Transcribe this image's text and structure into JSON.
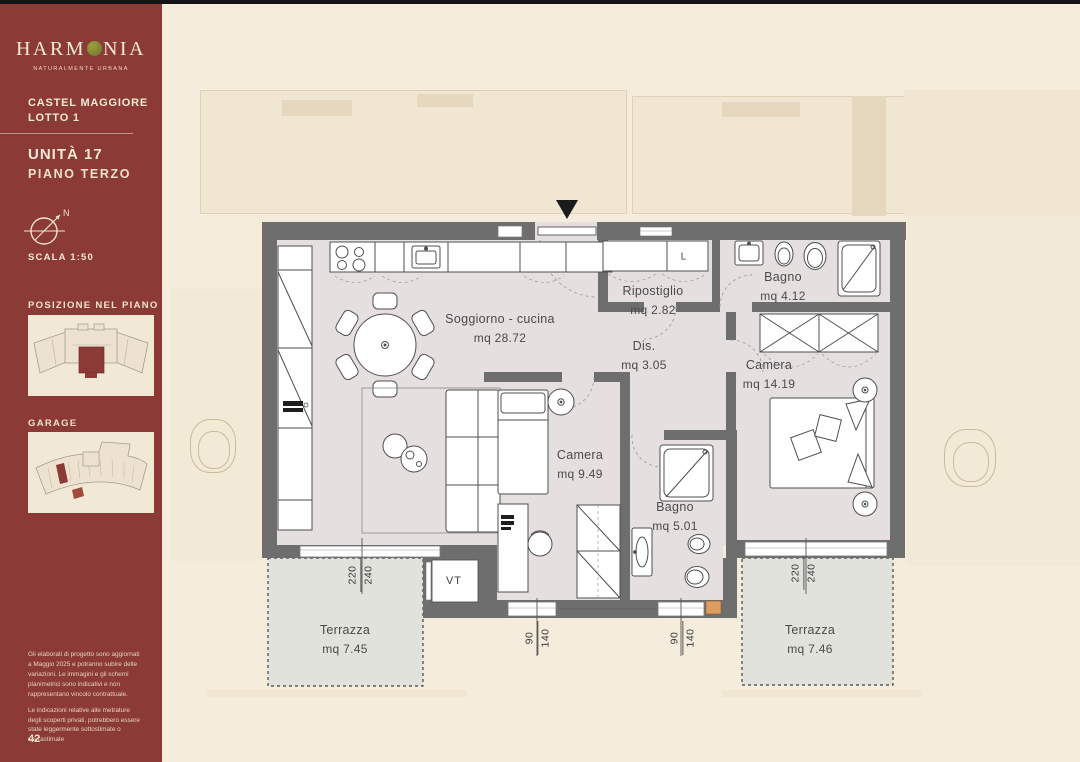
{
  "page": {
    "number": "42"
  },
  "sidebar": {
    "logo": {
      "part1": "HARM",
      "part2": "NIA",
      "tagline": "NATURALMENTE URBANA"
    },
    "project": {
      "name": "CASTEL MAGGIORE",
      "lot": "LOTTO 1"
    },
    "unit": {
      "title": "UNITÀ 17",
      "floor": "PIANO TERZO"
    },
    "compass": {
      "north": "N",
      "scale": "SCALA 1:50"
    },
    "sections": {
      "position": "POSIZIONE NEL PIANO",
      "garage": "GARAGE"
    },
    "disclaimer": {
      "p1": "Gli elaborati di progetto sono aggiornati a Maggio 2025 e potranno subire delle variazioni. Le immagini e gli schemi planimetrici sono indicativi e non rappresentano vincolo contrattuale.",
      "p2": "Le indicazioni relative alle metrature degli scoperti privati, potrebbero essere state leggermente sottostimate o sovrastimate"
    }
  },
  "floorplan": {
    "rooms": {
      "soggiorno": {
        "name": "Soggiorno - cucina",
        "area": "mq 28.72"
      },
      "ripostiglio": {
        "name": "Ripostiglio",
        "area": "mq 2.82"
      },
      "bagno_1": {
        "name": "Bagno",
        "area": "mq 4.12"
      },
      "disimpegno": {
        "name": "Dis.",
        "area": "mq 3.05"
      },
      "camera_1": {
        "name": "Camera",
        "area": "mq 14.19"
      },
      "camera_2": {
        "name": "Camera",
        "area": "mq 9.49"
      },
      "bagno_2": {
        "name": "Bagno",
        "area": "mq 5.01"
      },
      "terrazza_1": {
        "name": "Terrazza",
        "area": "mq 7.45"
      },
      "terrazza_2": {
        "name": "Terrazza",
        "area": "mq 7.46"
      }
    },
    "tags": {
      "laundry": "L",
      "tech_compartment": "VT"
    },
    "dimensions": {
      "window_left": {
        "a": "220",
        "b": "240"
      },
      "window_bottom_left": {
        "a": "90",
        "b": "140"
      },
      "window_bottom_right": {
        "a": "90",
        "b": "140"
      },
      "window_right": {
        "a": "220",
        "b": "240"
      }
    }
  },
  "colors": {
    "sidebar": "#8C3A35",
    "background": "#F5ECDC",
    "plan_interior": "#E6DFDF",
    "wall": "#6E6E6E",
    "olive": "#7C8133",
    "terrace": "#E2E2DD"
  }
}
